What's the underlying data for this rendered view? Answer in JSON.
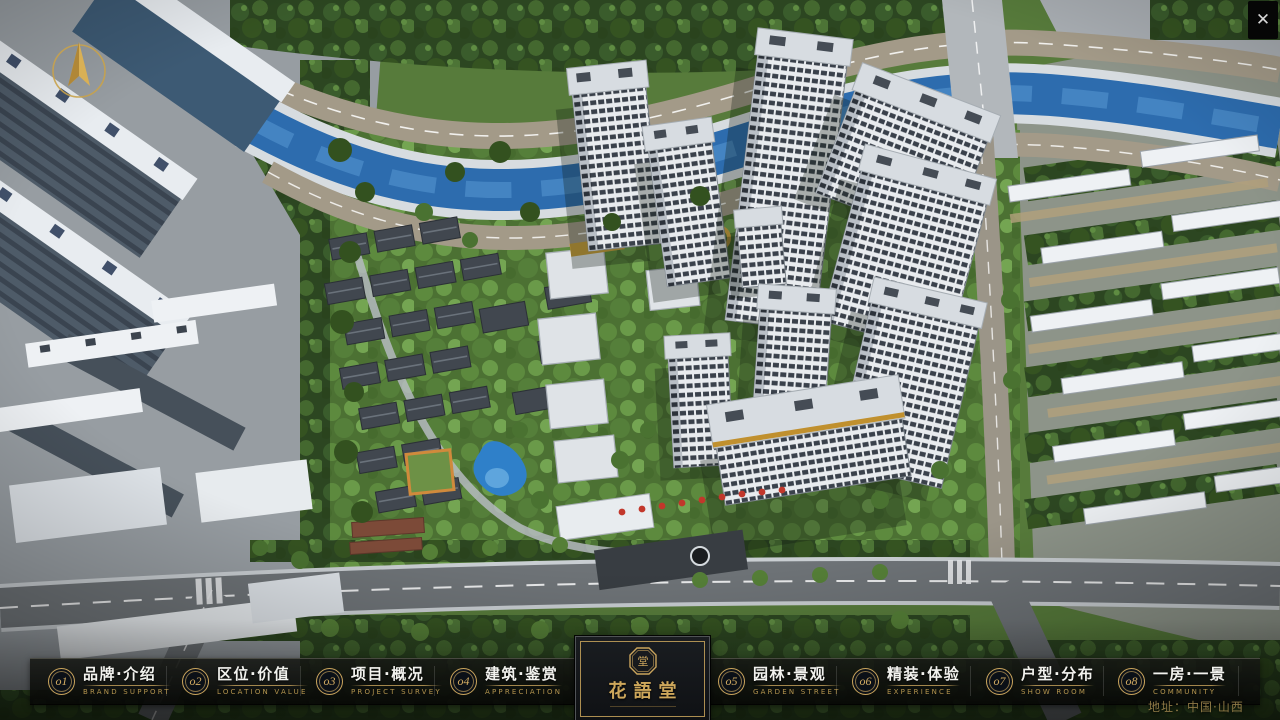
{
  "theme": {
    "gold": "#c9a45c",
    "bar_background": "#101210",
    "river_blue": "#2f6db0",
    "flag_red": "#c2372b",
    "foliage_green": "#3a5c2c"
  },
  "window": {
    "close_glyph": "✕"
  },
  "menu": {
    "items": [
      {
        "num": "o1",
        "zh": "品牌·介绍",
        "en": "BRAND SUPPORT"
      },
      {
        "num": "o2",
        "zh": "区位·价值",
        "en": "LOCATION VALUE"
      },
      {
        "num": "o3",
        "zh": "项目·概况",
        "en": "PROJECT SURVEY"
      },
      {
        "num": "o4",
        "zh": "建筑·鉴赏",
        "en": "APPRECIATION"
      },
      {
        "num": "o5",
        "zh": "园林·景观",
        "en": "GARDEN STREET"
      },
      {
        "num": "o6",
        "zh": "精装·体验",
        "en": "EXPERIENCE"
      },
      {
        "num": "o7",
        "zh": "户型·分布",
        "en": "SHOW ROOM"
      },
      {
        "num": "o8",
        "zh": "一房·一景",
        "en": "COMMUNITY"
      }
    ]
  },
  "logo": {
    "title": "花語堂",
    "seal_text": "堂"
  },
  "footer": {
    "address": "地址：中国·山西"
  }
}
